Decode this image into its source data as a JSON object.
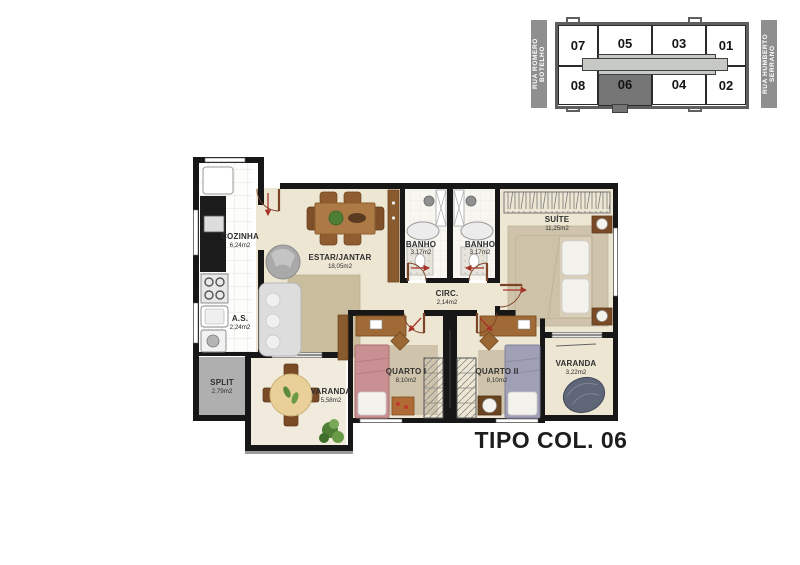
{
  "title": "TIPO COL. 06",
  "key_plan": {
    "street_left": "RUA ROMERO BOTELHO",
    "street_right": "RUA HUMBERTO SERRANO",
    "units": {
      "top": [
        "07",
        "05",
        "03",
        "01"
      ],
      "bottom": [
        "08",
        "06",
        "04",
        "02"
      ]
    },
    "highlighted_unit": "06"
  },
  "rooms": {
    "cozinha": {
      "label": "COZINHA",
      "area": "6,24m2"
    },
    "as": {
      "label": "A.S.",
      "area": "2,24m2"
    },
    "split": {
      "label": "SPLIT",
      "area": "2,79m2"
    },
    "estar_jantar": {
      "label": "ESTAR/JANTAR",
      "area": "18,05m2"
    },
    "banho_1": {
      "label": "BANHO",
      "area": "3,17m2"
    },
    "banho_2": {
      "label": "BANHO",
      "area": "3,17m2"
    },
    "suite": {
      "label": "SUÍTE",
      "area": "11,25m2"
    },
    "circ": {
      "label": "CIRC.",
      "area": "2,14m2"
    },
    "quarto_1": {
      "label": "QUARTO I",
      "area": "8,10m2"
    },
    "quarto_2": {
      "label": "QUARTO II",
      "area": "8,10m2"
    },
    "varanda_1": {
      "label": "VARANDA",
      "area": "5,58m2"
    },
    "varanda_2": {
      "label": "VARANDA",
      "area": "3,22m2"
    }
  },
  "colors": {
    "wall": "#171717",
    "floor": "#EDE6D3",
    "floor_light": "#F0EBDC",
    "rug": "#C9BD9E",
    "kitchen_floor": "#FDFDFC",
    "split_gray": "#AFAFAF",
    "street_bar": "#8F8F8F",
    "corridor": "#C6C9C4",
    "unit_highlight": "#757575",
    "wood": "#A06A36",
    "arrow_red": "#A83328"
  }
}
